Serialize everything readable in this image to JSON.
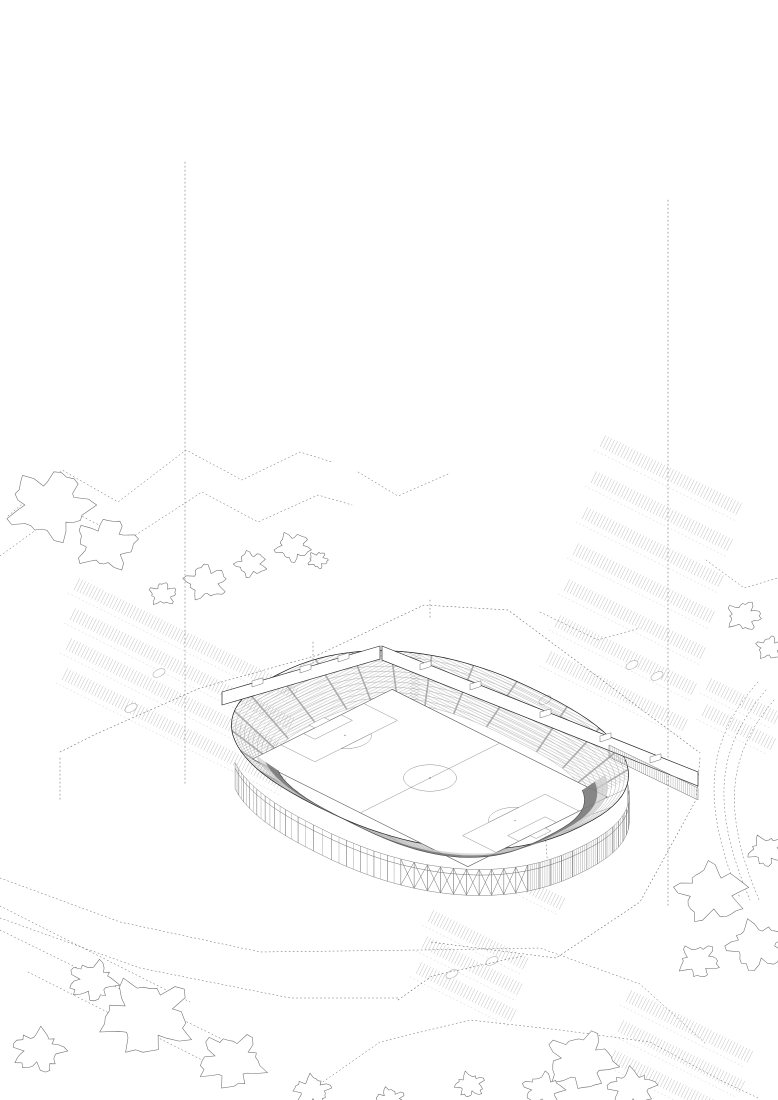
{
  "drawing": {
    "description": "Exploded axonometric line drawing of a football stadium in three stacked levels: roof canopy slab, upper seating tier ring on columns, and ground level with pitch, lower seating bowl and a curved podium building, surrounded by parking lots, trees and dotted site contours",
    "sheet": {
      "width": 778,
      "height": 1100
    }
  },
  "layers": [
    {
      "id": "roof",
      "name": "roof-canopy"
    },
    {
      "id": "upper-tier",
      "name": "upper-seating-tier"
    },
    {
      "id": "ground",
      "name": "ground-level-pitch-and-podium"
    }
  ],
  "annotations": {
    "north_arrow": true
  },
  "colors": {
    "background": "#ffffff",
    "frame": "#c6c6c6",
    "ink": "#1c1c1c",
    "mid": "#6f6f6f",
    "light": "#9e9e9e",
    "faint": "#c4c4c4",
    "face": "#f1f1f1",
    "hatch": "#a3a3a3",
    "seat": "#9a9a9a",
    "stair": "#2d2d2d",
    "rim": "#7c7c7c",
    "rim2": "#cccccc",
    "dotted": "#5f5f5f",
    "tree": "#6a6a6a",
    "parking": "#b6b6b6",
    "pitchline": "#8f8f8f"
  }
}
